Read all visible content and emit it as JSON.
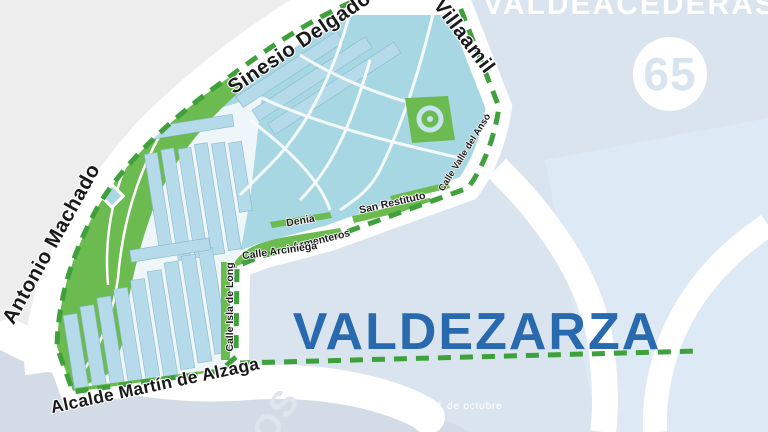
{
  "labels": {
    "adjacent_district": "VALDEACEDERAS",
    "district_number": "65",
    "neighborhood": "VALDEZARZA",
    "partial_word": "OS",
    "caption": "el 1 de octubre"
  },
  "streets": {
    "antonio_machado": "Antonio Machado",
    "sinesio_delgado": "Sinesio Delgado",
    "villaamil": "Villaamil",
    "alcalde_martin_de_alzaga": "Alcalde Martín de Alzaga",
    "san_restituto": "San Restituto",
    "denia": "Denia",
    "armenteros": "Armenteros",
    "calle_arciniega": "Calle Arciniega",
    "calle_isla_de_long": "Calle Isla de Long",
    "calle_valle_del_anso": "Calle Valle del Ansó"
  },
  "colors": {
    "background": "#d9e4ef",
    "outside_gray": "#ededee",
    "neighborhood_fill": "#a7d7e3",
    "building_fill": "#b5daea",
    "park_green": "#6cbb50",
    "boundary_dash_green": "#3ea13b",
    "title_blue": "#2969ae",
    "road_white": "#ffffff"
  }
}
